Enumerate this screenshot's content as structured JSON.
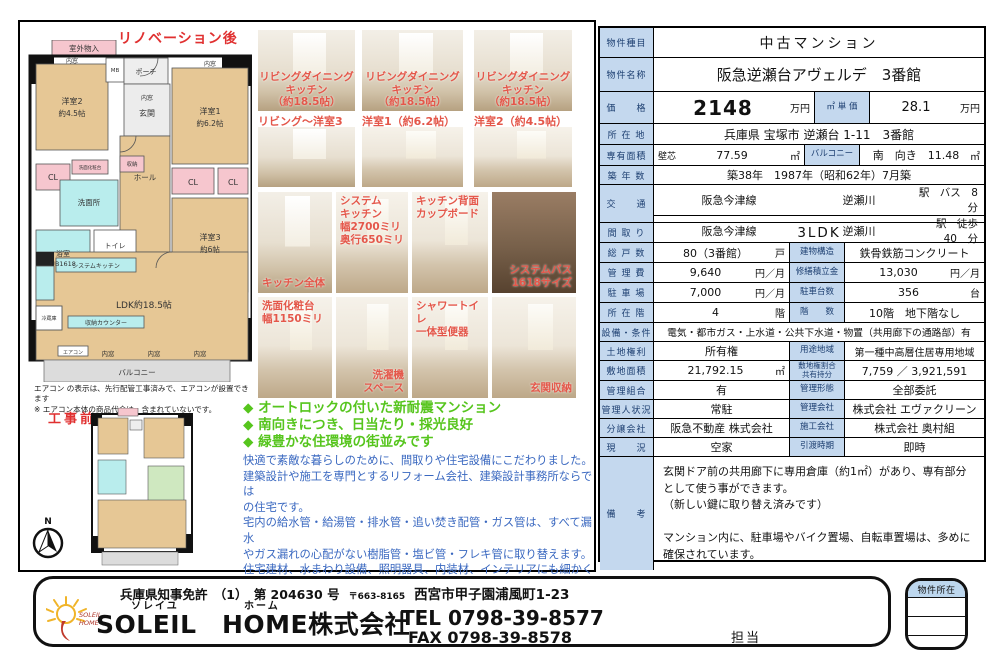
{
  "colors": {
    "table_label_bg": "#c4d8ee",
    "caption_red": "#e4574a",
    "feature_green": "#56c51d",
    "description_blue": "#3a68c0",
    "plan_room_tan": "#e6c795",
    "plan_closet_pink": "#f6c6ce",
    "plan_wet_cyan": "#b9eded",
    "plan_balcony_gray": "#dcdcdc"
  },
  "left": {
    "after_label": "リノベーション後",
    "before_label": "工事前",
    "plan": {
      "outdoor": "室外物入",
      "mb": "MB",
      "porch": "ポーチ",
      "uchimado": "内窓",
      "genkan": "玄関",
      "room2": "洋室2",
      "room2_size": "約4.5帖",
      "room1": "洋室1",
      "room1_size": "約6.2帖",
      "hall": "ホール",
      "cl": "CL",
      "vanity": "洗面化粧台",
      "shuno": "収納",
      "senmenjo": "洗面所",
      "bath": "浴室",
      "bath_size": "UB1618",
      "toilet": "トイレ",
      "room3": "洋室3",
      "room3_size": "約6帖",
      "kitchen": "システムキッチン",
      "fridge": "冷蔵庫",
      "counter": "収納カウンター",
      "ldk": "LDK約18.5帖",
      "aircon": "エアコン",
      "balcony": "バルコニー",
      "compass_n": "N"
    },
    "notes": "エアコン の表示は、先行配管工事済みで、エアコンが設置できます\n※ エアコン本体の商品代金は、含まれていないです。"
  },
  "photos": [
    {
      "caption": "リビングダイニングキッチン\n（約18.5帖）"
    },
    {
      "caption": "リビングダイニングキッチン\n（約18.5帖）"
    },
    {
      "caption": "リビングダイニングキッチン\n（約18.5帖）"
    },
    {
      "label": "リビング～洋室3"
    },
    {
      "label": "洋室1（約6.2帖）"
    },
    {
      "label": "洋室2（約4.5帖）"
    },
    {
      "caption": "キッチン全体"
    },
    {
      "caption": "システム\nキッチン\n幅2700ミリ\n奥行650ミリ"
    },
    {
      "caption": "キッチン背面\nカップボード"
    },
    {
      "caption": "システムバス\n1618サイズ"
    },
    {
      "caption": "洗面化粧台\n幅1150ミリ"
    },
    {
      "caption": "洗濯機\nスペース"
    },
    {
      "caption": "シャワートイレ\n一体型便器"
    },
    {
      "caption": "玄関収納"
    }
  ],
  "features": {
    "f1": "◆ オートロックの付いた新耐震マンション",
    "f2": "◆ 南向きにつき、日当たり・採光良好",
    "f3": "◆ 緑豊かな住環境の街並みです"
  },
  "description": "快適で素敵な暮らしのために、間取りや住宅設備にこだわりました。\n建築設計や施工を専門とするリフォーム会社、建築設計事務所ならでは\nの住宅です。\n宅内の給水管・給湯管・排水管・追い焚き配管・ガス管は、すべて漏水\nやガス漏れの心配がない樹脂管・塩ビ管・フレキ管に取り替えます。\n住宅建材、水まわり設備、照明器具、内装材、インテリアにも細かく\n配慮しています。（高品質な仕様です）",
  "table": {
    "rows": [
      {
        "label": "物件種目",
        "value": "中古マンション"
      },
      {
        "label": "物件名称",
        "value": "阪急逆瀬台アヴェルデ　3番館"
      },
      {
        "label": "価　　格",
        "value": "2148",
        "unit": "万円",
        "label2": "㎡ 単 価",
        "value2": "28.1",
        "unit2": "万円"
      },
      {
        "label": "所 在 地",
        "value": "兵庫県 宝塚市 逆瀬台 1-11　3番館"
      },
      {
        "label": "専有面積",
        "prefix": "壁芯",
        "value": "77.59",
        "unit": "㎡",
        "label2": "バルコニー",
        "value2": "南　向き　11.48",
        "unit2": "㎡"
      },
      {
        "label": "築 年 数",
        "value": "築38年　1987年（昭和62年）7月築"
      },
      {
        "label": "交　　通",
        "value": "阪急今津線",
        "value2": "逆瀬川",
        "value3": "駅　バス　8　分"
      },
      {
        "value": "阪急今津線",
        "value2": "逆瀬川",
        "value3": "駅　徒歩　40　分"
      },
      {
        "label": "間 取 り",
        "value": "3LDK"
      },
      {
        "label": "総 戸 数",
        "value": "80（3番館）",
        "unit": "戸",
        "label2": "建物構造",
        "value2": "鉄骨鉄筋コンクリート"
      },
      {
        "label": "管 理 費",
        "value": "9,640",
        "unit": "円／月",
        "label2": "修繕積立金",
        "value2": "13,030",
        "unit2": "円／月"
      },
      {
        "label": "駐 車 場",
        "value": "7,000",
        "unit": "円／月",
        "label2": "駐車台数",
        "value2": "356",
        "unit2": "台"
      },
      {
        "label": "所 在 階",
        "value": "4",
        "unit": "階",
        "label2": "階　　数",
        "value2": "10階　地下階なし"
      },
      {
        "label": "設備・条件",
        "value": "電気・都市ガス・上水道・公共下水道・物置（共用廊下の通路部）有"
      },
      {
        "label": "土地権利",
        "value": "所有権",
        "label2": "用途地域",
        "value2": "第一種中高層住居専用地域"
      },
      {
        "label": "敷地面積",
        "value": "21,792.15",
        "unit": "㎡",
        "label2": "敷地権割合\n共有持分",
        "value2": "7,759 ／ 3,921,591"
      },
      {
        "label": "管理組合",
        "value": "有",
        "label2": "管理形態",
        "value2": "全部委託"
      },
      {
        "label": "管理人状況",
        "value": "常駐",
        "label2": "管理会社",
        "value2": "株式会社 エヴァクリーン"
      },
      {
        "label": "分譲会社",
        "value": "阪急不動産 株式会社",
        "label2": "施工会社",
        "value2": "株式会社 奥村組"
      },
      {
        "label": "現　　況",
        "value": "空家",
        "label2": "引渡時期",
        "value2": "即時"
      },
      {
        "label": "備　　考",
        "value": "玄関ドア前の共用廊下に専用倉庫（約1㎡）があり、専有部分\nとして使う事ができます。\n（新しい鍵に取り替え済みです）\n\nマンション内に、駐車場やバイク置場、自転車置場は、多めに\n確保されています。"
      }
    ]
  },
  "footer": {
    "license": "兵庫県知事免許　（1）　第 204630 号",
    "postal": "〒663-8165",
    "address": "西宮市甲子園浦風町1-23",
    "furigana1": "ソレイユ",
    "furigana2": "ホーム",
    "company": "SOLEIL　HOME株式会社",
    "tel": "TEL 0798-39-8577",
    "fax": "FAX 0798-39-8578",
    "staff": "担当",
    "logo_line1": "SOLEIL",
    "logo_line2": "HOME",
    "property_location": "物件所在"
  }
}
